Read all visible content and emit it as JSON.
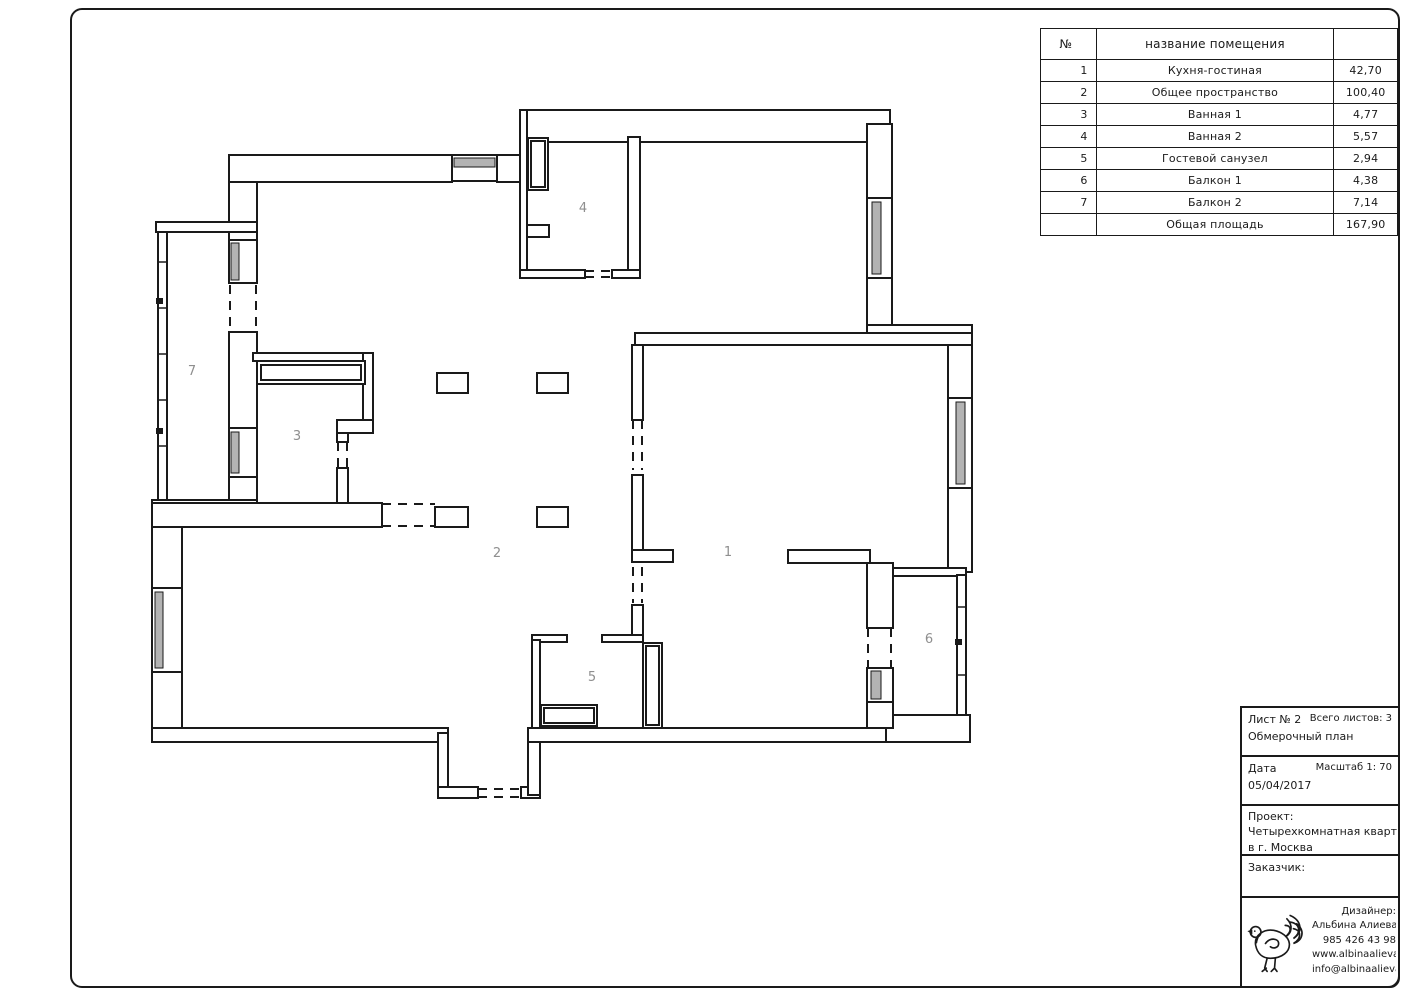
{
  "sheet": {
    "background": "#ffffff",
    "line_color": "#1a1a1a",
    "glazing_color": "#b3b3b3",
    "label_color": "#8f8f8f"
  },
  "table": {
    "header": {
      "num": "№",
      "name": "название помещения",
      "area": ""
    },
    "rows": [
      {
        "num": "1",
        "name": "Кухня-гостиная",
        "area": "42,70"
      },
      {
        "num": "2",
        "name": "Общее пространство",
        "area": "100,40"
      },
      {
        "num": "3",
        "name": "Ванная 1",
        "area": "4,77"
      },
      {
        "num": "4",
        "name": "Ванная 2",
        "area": "5,57"
      },
      {
        "num": "5",
        "name": "Гостевой санузел",
        "area": "2,94"
      },
      {
        "num": "6",
        "name": "Балкон 1",
        "area": "4,38"
      },
      {
        "num": "7",
        "name": "Балкон 2",
        "area": "7,14"
      }
    ],
    "total": {
      "num": "",
      "name": "Общая площадь",
      "area": "167,90"
    }
  },
  "title_block": {
    "sheet_label": "Лист № 2",
    "total_sheets_label": "Всего листов: 3",
    "doc_type": "Обмерочный план",
    "date_label": "Дата",
    "scale_label": "Масштаб 1: 70",
    "date_value": "05/04/2017",
    "project_label": "Проект:",
    "project_line1": "Четырехкомнатная квартира",
    "project_line2": "в г. Москва",
    "client_label": "Заказчик:"
  },
  "designer_block": {
    "label": "Дизайнер:",
    "name": "Альбина Алиева",
    "phone": "985 426 43 98",
    "website": "www.albinaalieva.com",
    "email": "info@albinaalieva.com",
    "logo": "dove-ornament"
  },
  "plan": {
    "rooms": [
      {
        "number": "1"
      },
      {
        "number": "2"
      },
      {
        "number": "3"
      },
      {
        "number": "4"
      },
      {
        "number": "5"
      },
      {
        "number": "6"
      },
      {
        "number": "7"
      }
    ]
  }
}
